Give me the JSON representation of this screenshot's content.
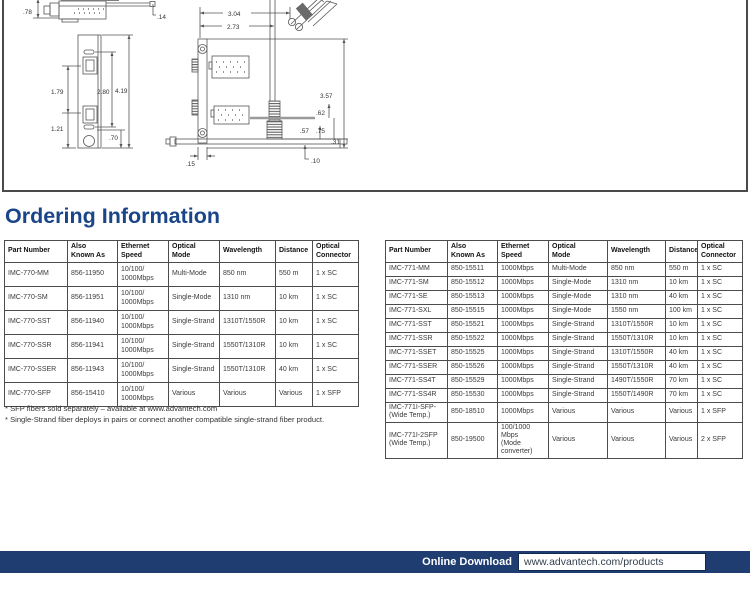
{
  "title": "Ordering Information",
  "colors": {
    "heading_navy": "#1a4689",
    "footer_navy": "#203d72",
    "table_border": "#4c4c4c"
  },
  "diagram": {
    "labels": [
      {
        "text": ".78",
        "x": 21,
        "y": 18
      },
      {
        "text": ".14",
        "x": 155,
        "y": 23
      },
      {
        "text": "1.79",
        "x": 49,
        "y": 98
      },
      {
        "text": "1.21",
        "x": 49,
        "y": 135
      },
      {
        "text": "2.80",
        "x": 95,
        "y": 98
      },
      {
        "text": "4.19",
        "x": 113,
        "y": 97
      },
      {
        "text": ".70",
        "x": 107,
        "y": 144
      },
      {
        "text": "3.04",
        "x": 226,
        "y": 20
      },
      {
        "text": "2.73",
        "x": 225,
        "y": 33
      },
      {
        "text": "3.57",
        "x": 318,
        "y": 102
      },
      {
        "text": ".62",
        "x": 314,
        "y": 119
      },
      {
        "text": ".57",
        "x": 298,
        "y": 137
      },
      {
        "text": ".75",
        "x": 314,
        "y": 137
      },
      {
        "text": ".31",
        "x": 329,
        "y": 148
      },
      {
        "text": ".10",
        "x": 309,
        "y": 167
      },
      {
        "text": ".15",
        "x": 184,
        "y": 170
      }
    ]
  },
  "tables": [
    {
      "name": "IMC-770",
      "columns": [
        "Part Number",
        "Also\nKnown As",
        "Ethernet\nSpeed",
        "Optical\nMode",
        "Wavelength",
        "Distance",
        "Optical\nConnector"
      ],
      "rows": [
        [
          "IMC-770-MM",
          "856-11950",
          "10/100/\n1000Mbps",
          "Multi-Mode",
          "850 nm",
          "550 m",
          "1 x SC"
        ],
        [
          "IMC-770-SM",
          "856-11951",
          "10/100/\n1000Mbps",
          "Single-Mode",
          "1310 nm",
          "10 km",
          "1 x SC"
        ],
        [
          "IMC-770-SST",
          "856-11940",
          "10/100/\n1000Mbps",
          "Single-Strand",
          "1310T/1550R",
          "10 km",
          "1 x SC"
        ],
        [
          "IMC-770-SSR",
          "856-11941",
          "10/100/\n1000Mbps",
          "Single-Strand",
          "1550T/1310R",
          "10 km",
          "1 x SC"
        ],
        [
          "IMC-770-SSER",
          "856-11943",
          "10/100/\n1000Mbps",
          "Single-Strand",
          "1550T/1310R",
          "40 km",
          "1 x SC"
        ],
        [
          "IMC-770-SFP",
          "856-15410",
          "10/100/\n1000Mbps",
          "Various",
          "Various",
          "Various",
          "1 x SFP"
        ]
      ]
    },
    {
      "name": "IMC-771",
      "columns": [
        "Part Number",
        "Also\nKnown As",
        "Ethernet\nSpeed",
        "Optical\nMode",
        "Wavelength",
        "Distance",
        "Optical\nConnector"
      ],
      "rows": [
        [
          "IMC-771-MM",
          "850-15511",
          "1000Mbps",
          "Multi-Mode",
          "850 nm",
          "550 m",
          "1 x SC"
        ],
        [
          "IMC-771-SM",
          "850-15512",
          "1000Mbps",
          "Single-Mode",
          "1310 nm",
          "10 km",
          "1 x SC"
        ],
        [
          "IMC-771-SE",
          "850-15513",
          "1000Mbps",
          "Single-Mode",
          "1310 nm",
          "40 km",
          "1 x SC"
        ],
        [
          "IMC-771-SXL",
          "850-15515",
          "1000Mbps",
          "Single-Mode",
          "1550 nm",
          "100 km",
          "1 x SC"
        ],
        [
          "IMC-771-SST",
          "850-15521",
          "1000Mbps",
          "Single-Strand",
          "1310T/1550R",
          "10 km",
          "1 x SC"
        ],
        [
          "IMC-771-SSR",
          "850-15522",
          "1000Mbps",
          "Single-Strand",
          "1550T/1310R",
          "10 km",
          "1 x SC"
        ],
        [
          "IMC-771-SSET",
          "850-15525",
          "1000Mbps",
          "Single-Strand",
          "1310T/1550R",
          "40 km",
          "1 x SC"
        ],
        [
          "IMC-771-SSER",
          "850-15526",
          "1000Mbps",
          "Single-Strand",
          "1550T/1310R",
          "40 km",
          "1 x SC"
        ],
        [
          "IMC-771-SS4T",
          "850-15529",
          "1000Mbps",
          "Single-Strand",
          "1490T/1550R",
          "70 km",
          "1 x SC"
        ],
        [
          "IMC-771-SS4R",
          "850-15530",
          "1000Mbps",
          "Single-Strand",
          "1550T/1490R",
          "70 km",
          "1 x SC"
        ],
        [
          "IMC-771I-SFP-\n(Wide Temp.)",
          "850-18510",
          "1000Mbps",
          "Various",
          "Various",
          "Various",
          "1 x SFP"
        ],
        [
          "IMC-771I-2SFP\n(Wide Temp.)",
          "850-19500",
          "100/1000 Mbps\n(Mode\nconverter)",
          "Various",
          "Various",
          "Various",
          "2 x SFP"
        ]
      ]
    }
  ],
  "footnotes": [
    "* SFP fibers sold separately – available at www.advantech.com",
    "* Single-Strand fiber deploys in pairs or connect another compatible single-strand fiber product."
  ],
  "footer": {
    "label": "Online Download",
    "url": "www.advantech.com/products"
  }
}
